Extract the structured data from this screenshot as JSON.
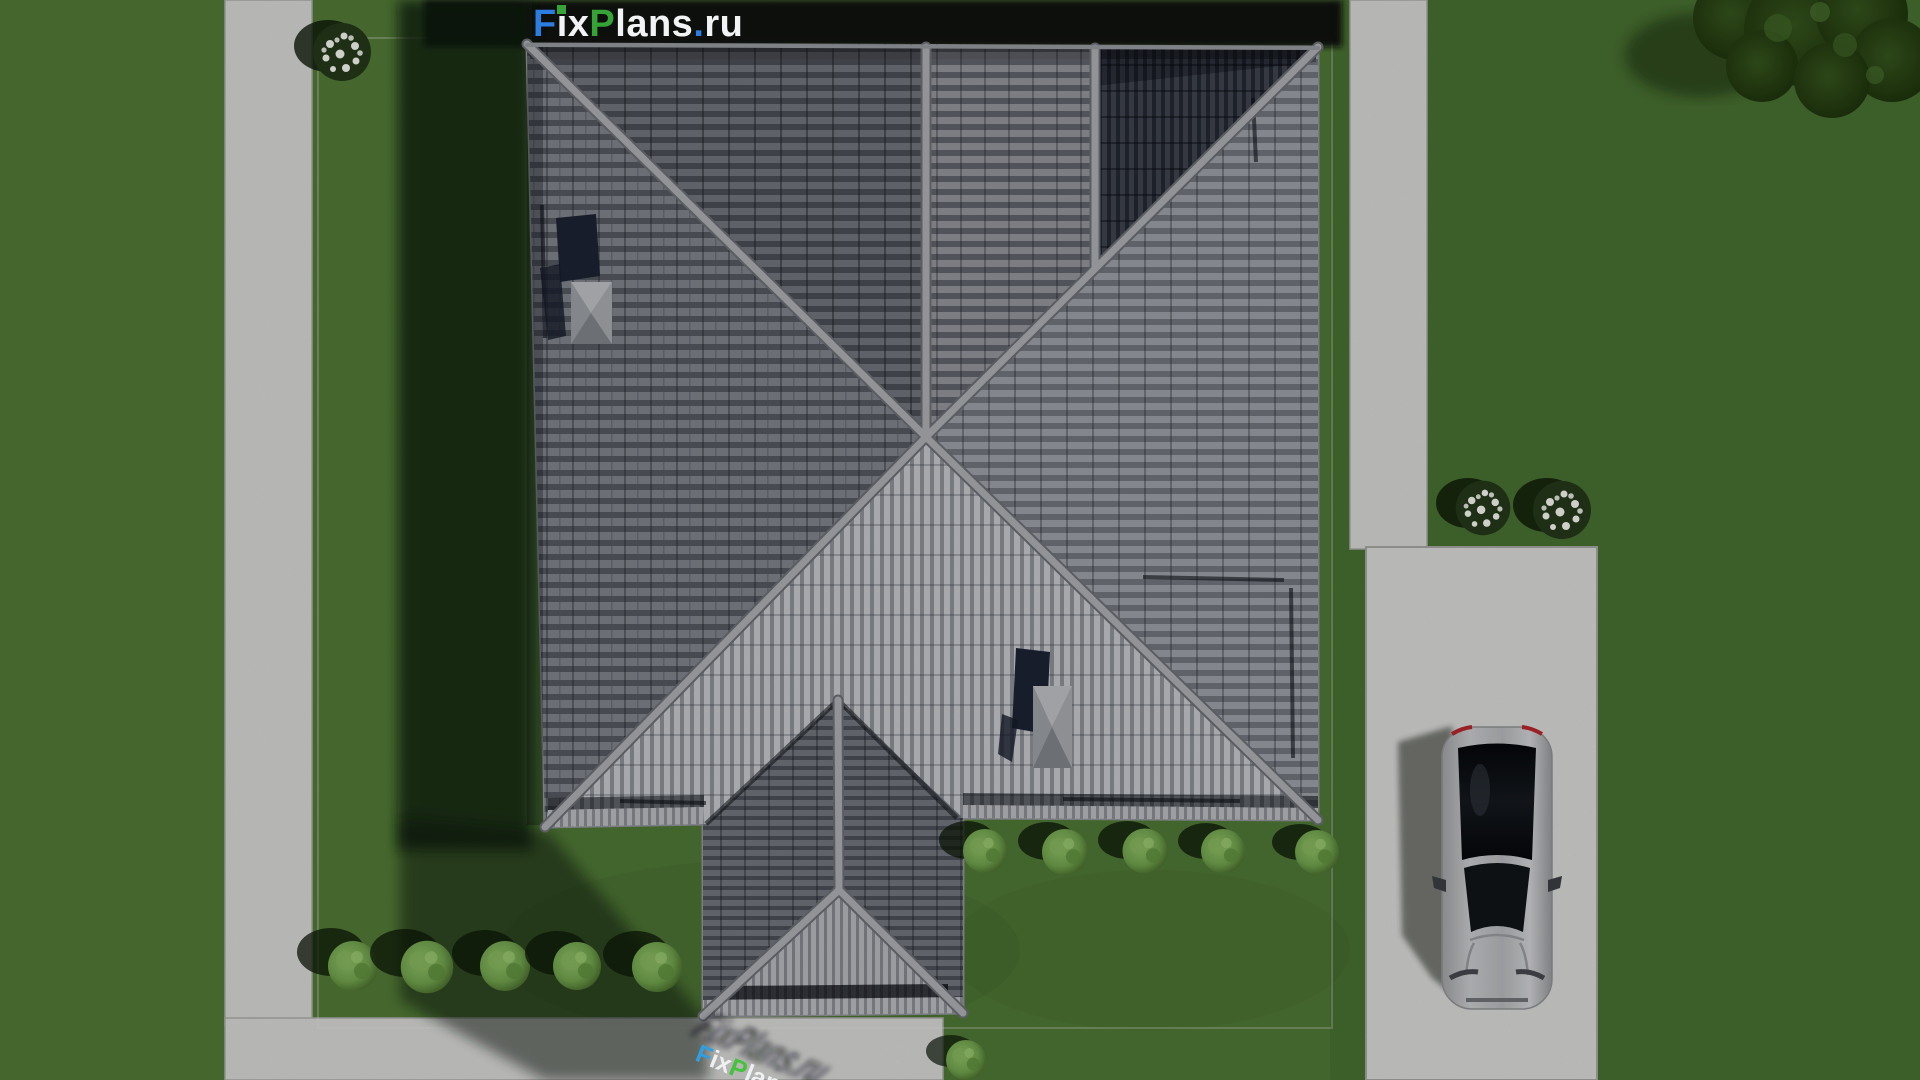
{
  "brand": {
    "logo_full": "FixPlans.ru",
    "f": "F",
    "i": "i",
    "x": "x",
    "p": "P",
    "lans": "lans",
    "dot": ".",
    "ru": "ru"
  },
  "watermark": {
    "f": "F",
    "i": "i",
    "x": "x",
    "p": "P",
    "lans": "lans",
    "dot": ".",
    "ru": "ru"
  },
  "palette": {
    "grass": "#4e7635",
    "grass-dark": "#3c5d27",
    "shadow-green": "#0c1408",
    "pavement": "#d4d4d2",
    "driveway": "#d7d7d5",
    "roof-bright": "#c3c5c9",
    "roof-mid": "#8a8d94",
    "roof-dark": "#3a3e49",
    "ridge": "#aaacb0",
    "ridge-edge": "#6a6d73",
    "chimney": "#1c2333",
    "skylight": "#9fa1a6",
    "logo-blue": "#2b7de1",
    "logo-green": "#36a336",
    "logo-white": "#f2f3f5",
    "wm-blue": "#2f9fe0",
    "wm-green": "#44c23c",
    "car-silver": "#b9babd",
    "car-glass": "#0e1114",
    "bush-green": "#6fa04c",
    "tree-green": "#22390f",
    "flower-white": "#f0f2ea"
  }
}
